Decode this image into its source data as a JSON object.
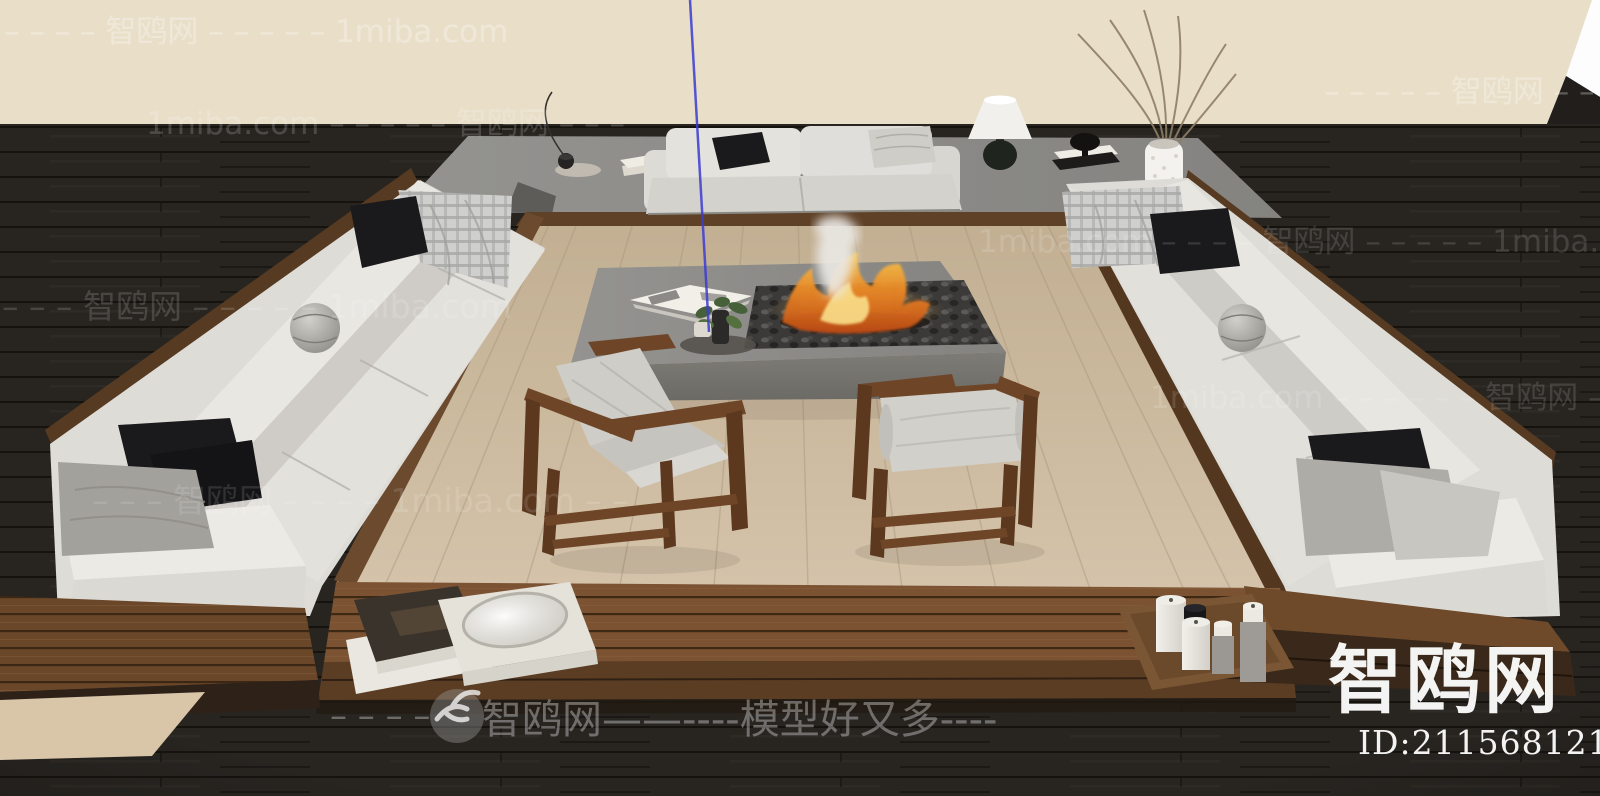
{
  "brand": {
    "site_name": "智鸥网",
    "site_alt": "1miba.com",
    "slogan": "模型好又多",
    "model_id": "ID:211568121"
  },
  "watermarks": {
    "rows": [
      {
        "text": "– – – – 智鸥网 – – – – – 1miba.com"
      },
      {
        "text": "– – – – – 智鸥网 – –"
      },
      {
        "text": "1miba.com – – – – – 智鸥网 – – –"
      },
      {
        "text": "1miba.com – – – – 智鸥网 – – – – – 1miba.com"
      },
      {
        "text": "– – – 智鸥网 – – – – – 1miba.com"
      },
      {
        "text": "1miba.com – – – – – – 智鸥网 – – –"
      },
      {
        "text": "– – – 智鸥网 – – – – 1miba.com – –"
      }
    ],
    "bottom_banner": {
      "pre_dashes": "– – – –",
      "text": "智鸥网——----模型好又多----"
    },
    "corner": {
      "logo_text": "智鸥网",
      "id_text": "ID:211568121"
    }
  },
  "palette": {
    "wall": "#e9dfc9",
    "floor": "#282521",
    "concrete": "#8f8e8a",
    "pit_wood": "#c9b79c",
    "platform_wood": "#7b5332",
    "sofa_white": "#dedcd7",
    "pillow_black": "#1a1a1c",
    "chair_wood": "#6f4527",
    "fire": "#e8872a",
    "axis_blue": "#3c3cd2",
    "watermark": "#ffffff"
  }
}
